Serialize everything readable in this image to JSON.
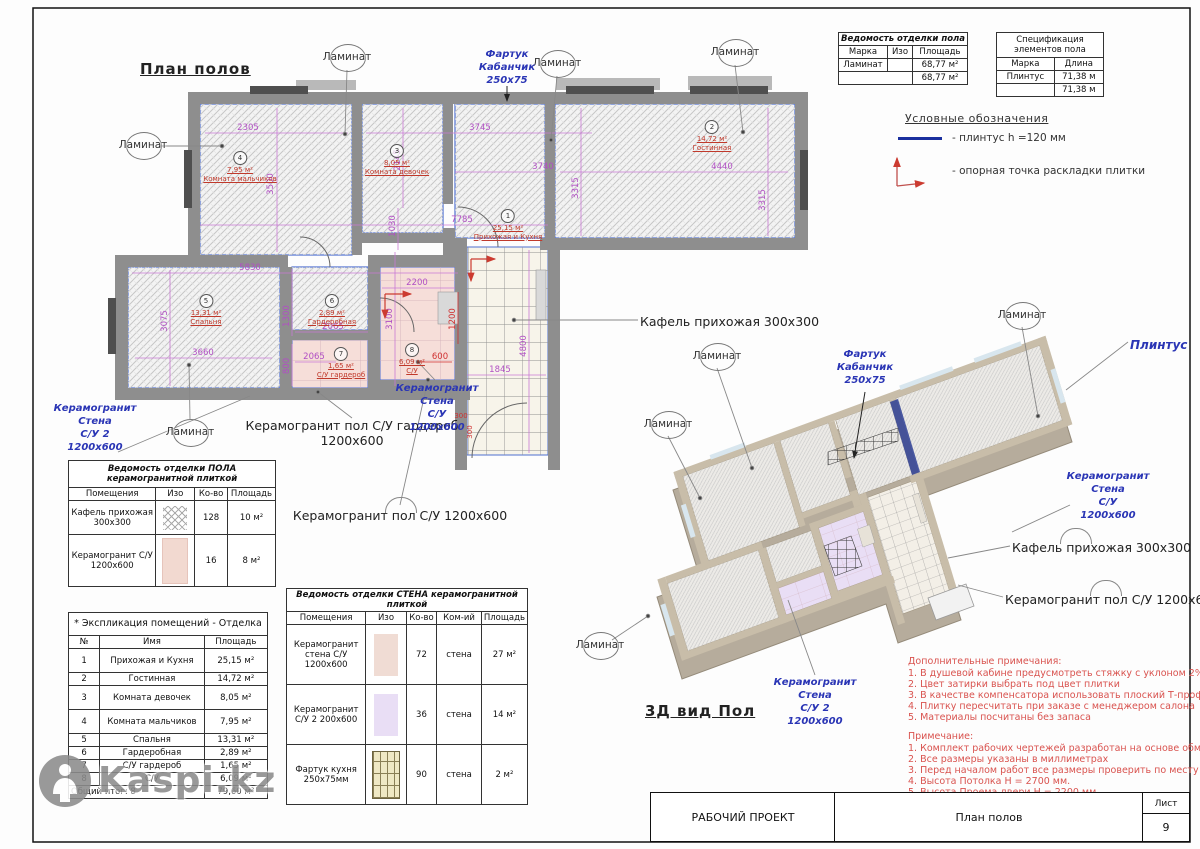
{
  "sheet": {
    "plan_title": "План полов",
    "view3d_title": "3Д вид Пол"
  },
  "labels": {
    "laminate": "Ламинат",
    "plinth": "Плинтус",
    "tile_hall": "Кафель прихожая 300х300",
    "pg_floor_su": "Керамогранит пол С/У 1200х600",
    "pg_floor_ward": [
      "Керамогранит пол С/У гардероб",
      "1200х600"
    ],
    "wall_su": [
      "Керамогранит",
      "Стена",
      "С/У",
      "1200х600"
    ],
    "wall_su2": [
      "Керамогранит",
      "Стена",
      "С/У 2",
      "1200х600"
    ],
    "apron": [
      "Фартук",
      "Кабанчик",
      "250х75"
    ]
  },
  "plan": {
    "dims": [
      "2305",
      "3745",
      "2145",
      "3500",
      "1030",
      "3740",
      "3315",
      "4440",
      "3315",
      "7785",
      "5830",
      "3075",
      "3660",
      "1300",
      "2065",
      "2065",
      "800",
      "2200",
      "3100",
      "600",
      "1200",
      "1845",
      "4800",
      "300",
      "300"
    ],
    "rooms": [
      {
        "num": "1",
        "area": "25,15 м²",
        "name": "Прихожая и Кухня"
      },
      {
        "num": "2",
        "area": "14,72 м²",
        "name": "Гостинная"
      },
      {
        "num": "3",
        "area": "8,05 м²",
        "name": "Комната девочек"
      },
      {
        "num": "4",
        "area": "7,95 м²",
        "name": "Комната мальчиков"
      },
      {
        "num": "5",
        "area": "13,31 м²",
        "name": "Спальня"
      },
      {
        "num": "6",
        "area": "2,89 м²",
        "name": "Гардеробная"
      },
      {
        "num": "7",
        "area": "1,65 м²",
        "name": "С/У гардероб"
      },
      {
        "num": "8",
        "area": "6,09 м²",
        "name": "С/У"
      }
    ]
  },
  "tables": {
    "floor_finish": {
      "title": "Ведомость отделки пола",
      "headers": [
        "Марка",
        "Изо",
        "Площадь"
      ],
      "row": {
        "mark": "Ламинат",
        "area": "68,77 м²"
      },
      "total": "68,77 м²"
    },
    "floor_elements": {
      "title": "Спецификация элементов пола",
      "headers": [
        "Марка",
        "Длина"
      ],
      "row": {
        "mark": "Плинтус",
        "len": "71,38 м"
      },
      "total": "71,38 м"
    },
    "floor_ceramic": {
      "title": "Ведомость отделки ПОЛА керамогранитной плиткой",
      "headers": [
        "Помещения",
        "Изо",
        "Ко-во",
        "Площадь"
      ],
      "rows": [
        {
          "name": "Кафель прихожая 300х300",
          "qty": "128",
          "area": "10 м²"
        },
        {
          "name": "Керамогранит С/У 1200х600",
          "qty": "16",
          "area": "8 м²"
        }
      ]
    },
    "rooms_expl": {
      "title": "* Экспликация помещений - Отделка",
      "headers": [
        "№",
        "Имя",
        "Площадь"
      ],
      "rows": [
        {
          "n": "1",
          "name": "Прихожая и Кухня",
          "area": "25,15 м²"
        },
        {
          "n": "2",
          "name": "Гостинная",
          "area": "14,72 м²"
        },
        {
          "n": "3",
          "name": "Комната девочек",
          "area": "8,05 м²"
        },
        {
          "n": "4",
          "name": "Комната мальчиков",
          "area": "7,95 м²"
        },
        {
          "n": "5",
          "name": "Спальня",
          "area": "13,31 м²"
        },
        {
          "n": "6",
          "name": "Гардеробная",
          "area": "2,89 м²"
        },
        {
          "n": "7",
          "name": "С/У гардероб",
          "area": "1,65 м²"
        },
        {
          "n": "8",
          "name": "С/У",
          "area": "6,09 м²"
        }
      ],
      "total_label": "Общий итог: 8",
      "total_area": "79,60 м²"
    },
    "wall_ceramic": {
      "title": "Ведомость отделки СТЕНА керамогранитной плиткой",
      "headers": [
        "Помещения",
        "Изо",
        "Ко-во",
        "Ком-ий",
        "Площадь"
      ],
      "rows": [
        {
          "name": "Керамогранит стена С/У 1200х600",
          "qty": "72",
          "com": "стена",
          "area": "27 м²"
        },
        {
          "name": "Керамогранит С/У 2 200х600",
          "qty": "36",
          "com": "стена",
          "area": "14 м²"
        },
        {
          "name": "Фартук кухня 250х75мм",
          "qty": "90",
          "com": "стена",
          "area": "2 м²"
        }
      ]
    }
  },
  "legend": {
    "title": "Условные обозначения",
    "items": [
      {
        "label": "- плинтус h =120 мм",
        "color": "#1a2f9e"
      },
      {
        "label": "- опорная точка раскладки плитки",
        "color": "#c0504d"
      }
    ]
  },
  "notes_additional": {
    "title": "Дополнительные примечания:",
    "items": [
      "1. В душевой кабине предусмотреть стяжку с уклоном 2%",
      "2. Цвет затирки выбрать под цвет плитки",
      "3. В качестве компенсатора использовать плоский Т-профиль",
      "4. Плитку пересчитать при заказе с менеджером салона",
      "5. Материалы посчитаны без запаса"
    ]
  },
  "notes_main": {
    "title": "Примечание:",
    "items": [
      "1. Комплект рабочих чертежей разработан на основе обмеров.",
      "2. Все размеры указаны в миллиметрах",
      "3. Перед началом работ все размеры проверить по месту",
      "4. Высота Потолка Н = 2700 мм.",
      "5. Высота Проема двери Н = 2200 мм."
    ]
  },
  "title_block": {
    "project": "РАБОЧИЙ ПРОЕКТ",
    "sheet_name": "План полов",
    "sheet_label": "Лист",
    "sheet_number": "9"
  },
  "watermark": {
    "text": "Kaspi.kz"
  }
}
